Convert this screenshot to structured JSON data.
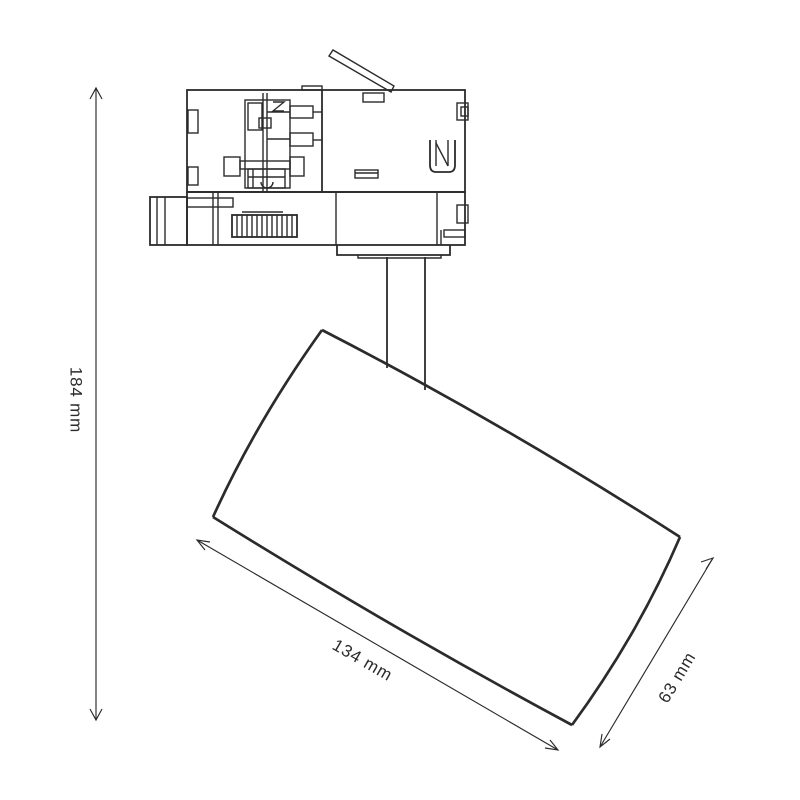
{
  "drawing": {
    "title": "track spotlight dimensional line drawing",
    "background": "#ffffff",
    "line_color": "#2b2b2b",
    "labels": {
      "height": "184 mm",
      "length": "134 mm",
      "diameter": "63 mm"
    },
    "parts": [
      "track-adapter",
      "release-lever",
      "stem",
      "cylindrical-lamp-head"
    ]
  }
}
